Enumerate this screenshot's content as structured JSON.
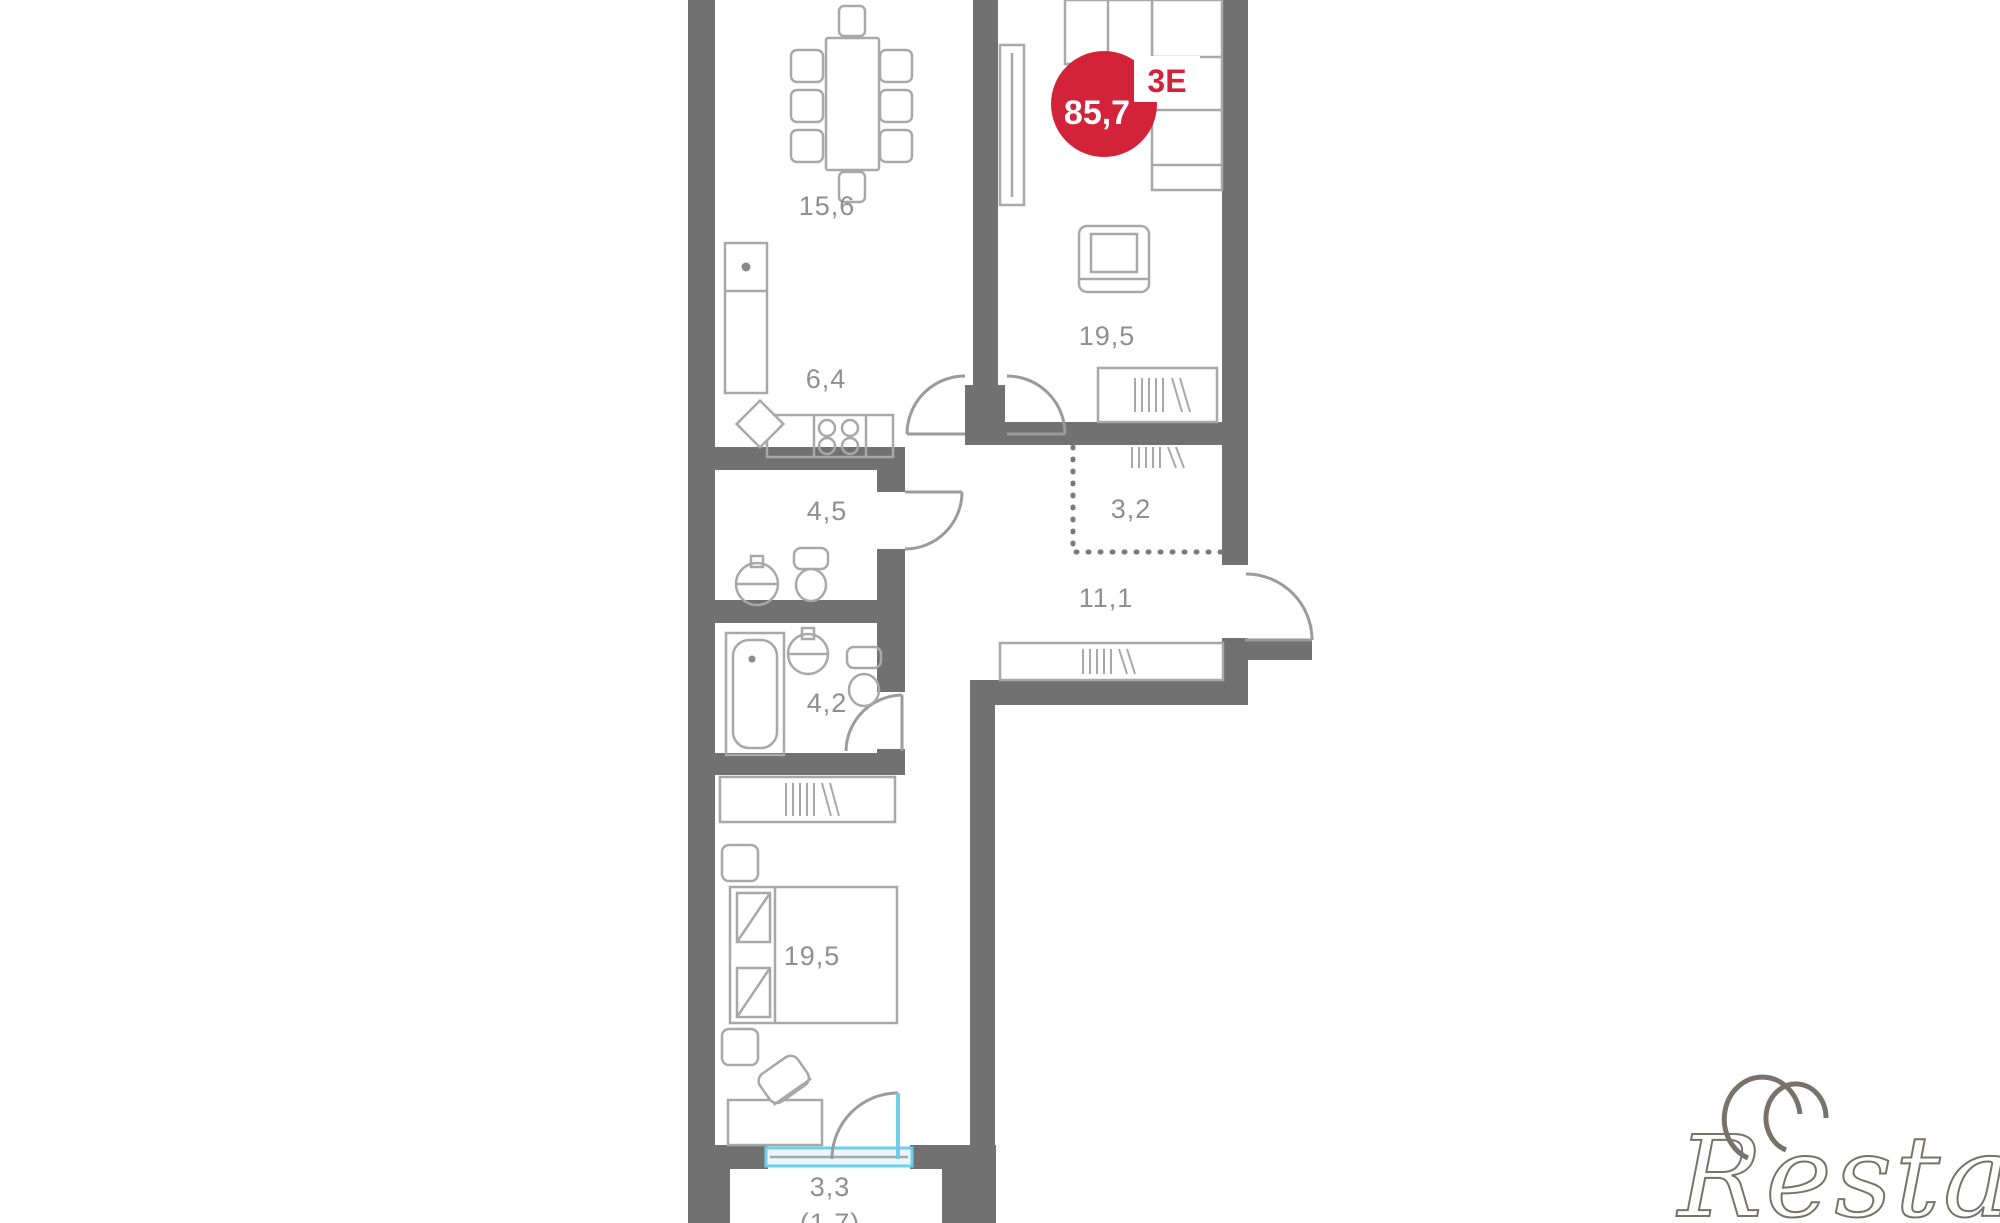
{
  "plan": {
    "badge": {
      "type_label": "3Е",
      "total_area": "85,7"
    },
    "rooms": {
      "dining": {
        "area": "15,6"
      },
      "kitchen": {
        "area": "6,4"
      },
      "living": {
        "area": "19,5"
      },
      "bathroom_upper": {
        "area": "4,5"
      },
      "closet": {
        "area": "3,2"
      },
      "hallway": {
        "area": "11,1"
      },
      "bathroom_lower": {
        "area": "4,2"
      },
      "bedroom": {
        "area": "19,5"
      },
      "balcony": {
        "area": "3,3",
        "area_with_coefficient": "(1,7)"
      }
    },
    "colors": {
      "wall": "#717171",
      "furniture_line": "#a8a8a8",
      "label_text": "#8f8f8f",
      "badge_red": "#d3233a",
      "badge_text": "#ffffff",
      "balcony_glazing": "#6fcfe8"
    }
  },
  "watermark": {
    "text": "Restate"
  }
}
